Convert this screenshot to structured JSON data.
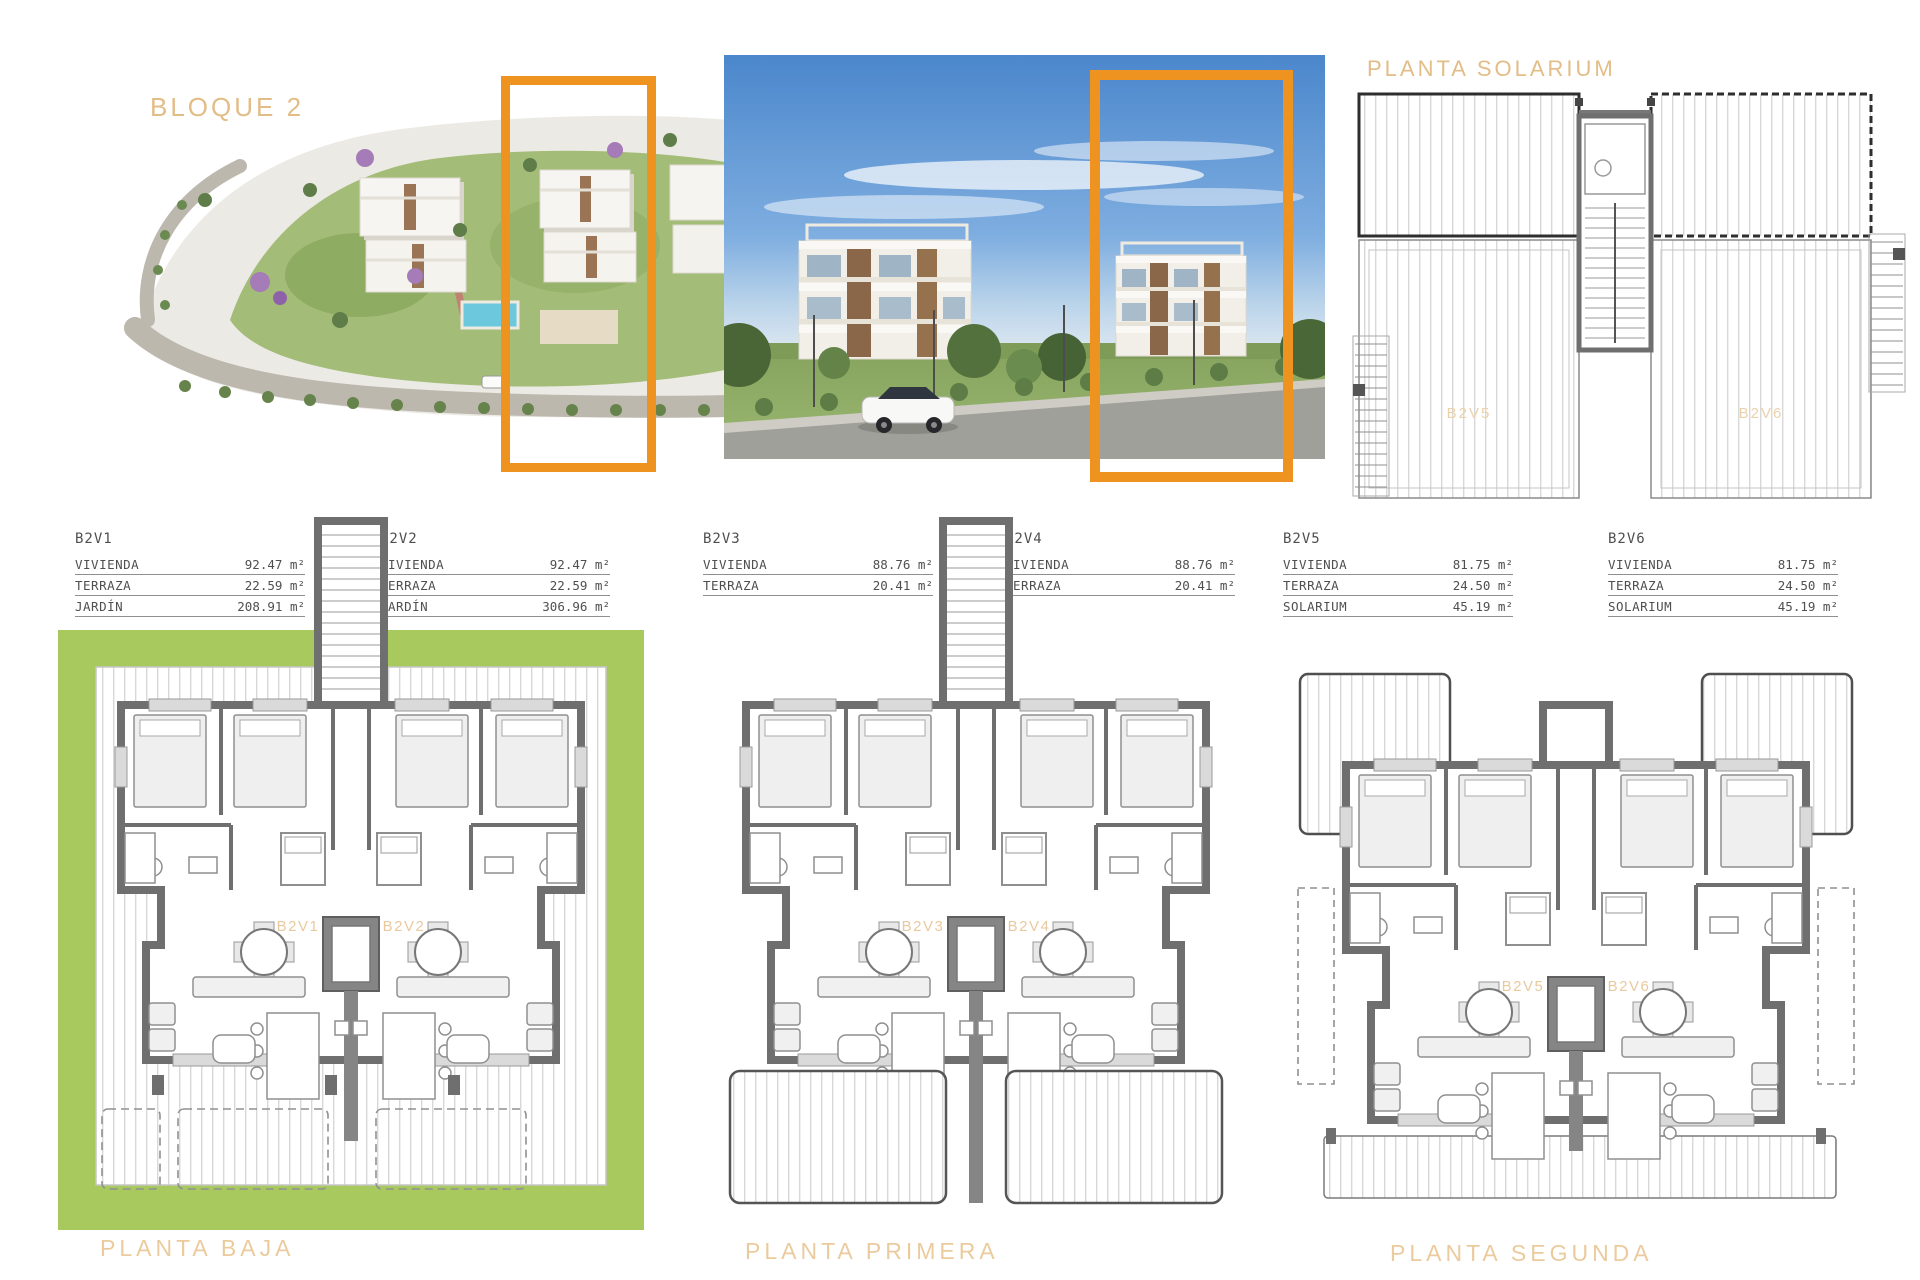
{
  "header": {
    "bloque_label": "BLOQUE 2",
    "solarium_label": "PLANTA SOLARIUM"
  },
  "unit_tables": [
    {
      "id": "B2V1",
      "rows": [
        {
          "label": "VIVIENDA",
          "value": "92.47 m²"
        },
        {
          "label": "TERRAZA",
          "value": "22.59 m²"
        },
        {
          "label": "JARDÍN",
          "value": "208.91 m²"
        }
      ]
    },
    {
      "id": "B2V2",
      "rows": [
        {
          "label": "VIVIENDA",
          "value": "92.47 m²"
        },
        {
          "label": "TERRAZA",
          "value": "22.59 m²"
        },
        {
          "label": "JARDÍN",
          "value": "306.96 m²"
        }
      ]
    },
    {
      "id": "B2V3",
      "rows": [
        {
          "label": "VIVIENDA",
          "value": "88.76 m²"
        },
        {
          "label": "TERRAZA",
          "value": "20.41 m²"
        }
      ]
    },
    {
      "id": "B2V4",
      "rows": [
        {
          "label": "VIVIENDA",
          "value": "88.76 m²"
        },
        {
          "label": "TERRAZA",
          "value": "20.41 m²"
        }
      ]
    },
    {
      "id": "B2V5",
      "rows": [
        {
          "label": "VIVIENDA",
          "value": "81.75 m²"
        },
        {
          "label": "TERRAZA",
          "value": "24.50 m²"
        },
        {
          "label": "SOLARIUM",
          "value": "45.19 m²"
        }
      ]
    },
    {
      "id": "B2V6",
      "rows": [
        {
          "label": "VIVIENDA",
          "value": "81.75 m²"
        },
        {
          "label": "TERRAZA",
          "value": "24.50 m²"
        },
        {
          "label": "SOLARIUM",
          "value": "45.19 m²"
        }
      ]
    }
  ],
  "floor_plans": [
    {
      "title": "PLANTA BAJA",
      "variant": "baja",
      "units": [
        "B2V1",
        "B2V2"
      ]
    },
    {
      "title": "PLANTA PRIMERA",
      "variant": "primera",
      "units": [
        "B2V3",
        "B2V4"
      ]
    },
    {
      "title": "PLANTA SEGUNDA",
      "variant": "segunda",
      "units": [
        "B2V5",
        "B2V6"
      ]
    }
  ],
  "solarium_plan": {
    "units": [
      "B2V5",
      "B2V6"
    ]
  },
  "colors": {
    "accent_orange": "#EE9320",
    "heading_tan": "#E2BD87",
    "garden_green": "#A8C95E",
    "wall_gray": "#6F6F6F",
    "unit_label_tan": "#E9C99E"
  }
}
